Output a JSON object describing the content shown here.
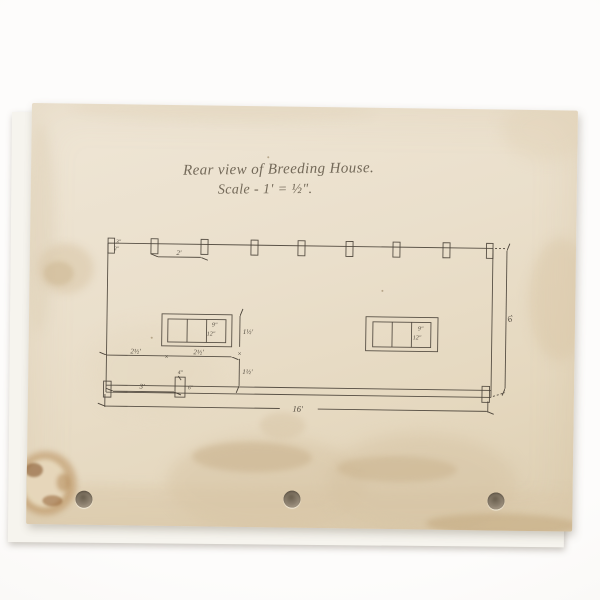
{
  "document": {
    "title_line1": "Rear view of Breeding House.",
    "title_line2": "Scale - 1' = ½\".",
    "colors": {
      "paper": "#e9dfca",
      "ink": "#4b4339",
      "pencil_text": "#62584a",
      "stain": "#d5c2a2",
      "backdrop": "#fdfcfb"
    },
    "labels": {
      "post_spacing": "2'",
      "corner_top": "3\"",
      "corner_bottom": "2\"",
      "window_left_pane_width": "9\"",
      "window_left_pane_height": "12\"",
      "window_right_pane_width": "9\"",
      "window_right_pane_height": "12\"",
      "window_height": "1½'",
      "below_window_height": "1½'",
      "wall_to_window": "2½'",
      "window_width": "2½'",
      "door_post_offset": "3'",
      "door_post_width": "4\"",
      "door_post_side": "6\"",
      "overall_width": "16'",
      "overall_height": "6'",
      "junction_marker": "×"
    }
  }
}
